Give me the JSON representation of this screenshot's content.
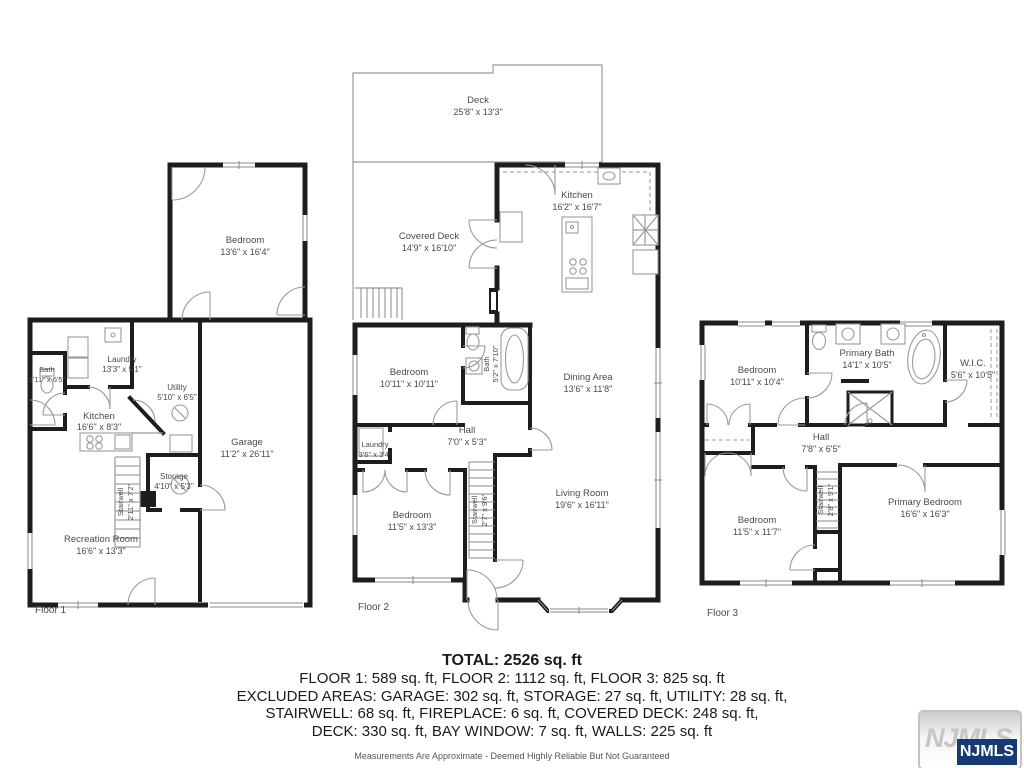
{
  "floors": [
    {
      "label": "Floor 1",
      "rooms": {
        "bedroom": {
          "name": "Bedroom",
          "dims": "13'6\" x 16'4\""
        },
        "bath": {
          "name": "Bath",
          "dims": "2'11\" x 6'5\""
        },
        "laundry": {
          "name": "Laundry",
          "dims": "13'3\" x 5'1\""
        },
        "utility": {
          "name": "Utility",
          "dims": "5'10\" x 6'5\""
        },
        "kitchen": {
          "name": "Kitchen",
          "dims": "16'6\" x 8'3\""
        },
        "garage": {
          "name": "Garage",
          "dims": "11'2\" x 26'11\""
        },
        "storage": {
          "name": "Storage",
          "dims": "4'10\" x 5'3\""
        },
        "stairwell": {
          "name": "Stairwell",
          "dims": "2'11\" x 7'2\""
        },
        "recreation": {
          "name": "Recreation Room",
          "dims": "16'6\" x 13'3\""
        }
      }
    },
    {
      "label": "Floor 2",
      "rooms": {
        "deck": {
          "name": "Deck",
          "dims": "25'8\" x 13'3\""
        },
        "covered_deck": {
          "name": "Covered Deck",
          "dims": "14'9\" x 16'10\""
        },
        "kitchen": {
          "name": "Kitchen",
          "dims": "16'2\" x 16'7\""
        },
        "bedroom1": {
          "name": "Bedroom",
          "dims": "10'11\" x 10'11\""
        },
        "bath": {
          "name": "Bath",
          "dims": "5'2\" x 7'10\""
        },
        "hall": {
          "name": "Hall",
          "dims": "7'0\" x 5'3\""
        },
        "laundry": {
          "name": "Laundry",
          "dims": "3'6\" x 3'4\""
        },
        "bedroom2": {
          "name": "Bedroom",
          "dims": "11'5\" x 13'3\""
        },
        "stairwell": {
          "name": "Stairwell",
          "dims": "2'7\" x 9'6\""
        },
        "dining": {
          "name": "Dining Area",
          "dims": "13'6\" x 11'8\""
        },
        "living": {
          "name": "Living Room",
          "dims": "19'6\" x 16'11\""
        }
      }
    },
    {
      "label": "Floor 3",
      "rooms": {
        "bedroom1": {
          "name": "Bedroom",
          "dims": "10'11\" x 10'4\""
        },
        "primary_bath": {
          "name": "Primary Bath",
          "dims": "14'1\" x 10'5\""
        },
        "wic": {
          "name": "W.I.C.",
          "dims": "5'6\" x 10'5\""
        },
        "hall": {
          "name": "Hall",
          "dims": "7'8\" x 6'5\""
        },
        "bedroom2": {
          "name": "Bedroom",
          "dims": "11'5\" x 11'7\""
        },
        "stairwell": {
          "name": "Stairwell",
          "dims": "2'8\" x 9'1\""
        },
        "primary_bedroom": {
          "name": "Primary Bedroom",
          "dims": "16'6\" x 16'3\""
        }
      }
    }
  ],
  "summary": {
    "total": "TOTAL: 2526 sq. ft",
    "line1": "FLOOR 1: 589 sq. ft, FLOOR 2: 1112 sq. ft, FLOOR 3: 825 sq. ft",
    "line2": "EXCLUDED AREAS: GARAGE: 302 sq. ft, STORAGE: 27 sq. ft, UTILITY: 28 sq. ft,",
    "line3": "STAIRWELL: 68 sq. ft, FIREPLACE: 6 sq. ft, COVERED DECK: 248 sq. ft,",
    "line4": "DECK: 330 sq. ft, BAY WINDOW: 7 sq. ft, WALLS: 225 sq. ft",
    "disclaimer": "Measurements Are Approximate - Deemed Highly Reliable But Not Guaranteed"
  },
  "logo": {
    "watermark": "NJMLS",
    "badge": "NJMLS"
  }
}
